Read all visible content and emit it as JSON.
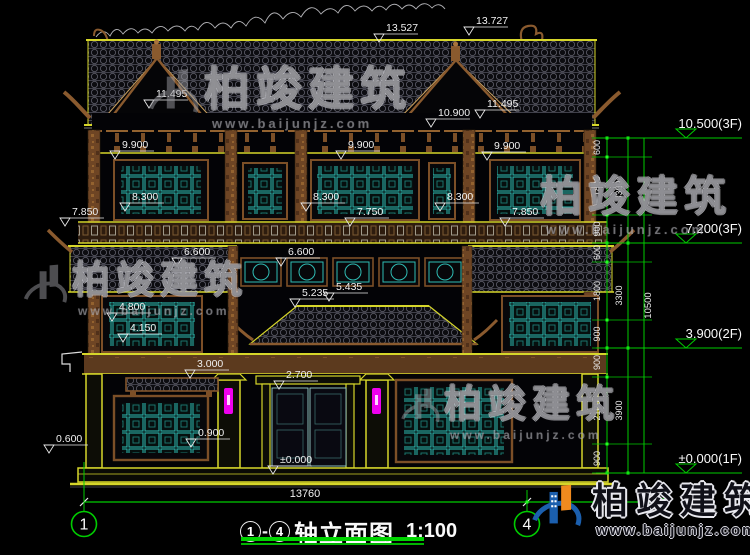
{
  "colors": {
    "background": "#000000",
    "dim_line_green": "#00cc00",
    "bright_green": "#22ff22",
    "outline_yellow": "#d6d62a",
    "wood_brown": "#8a5a2e",
    "window_teal": "#2fbcb4",
    "lamp_magenta": "#ee00ee",
    "text_white": "#f0f0f0",
    "logo_blue": "#1b5fae",
    "logo_orange": "#f08a1e"
  },
  "watermark": {
    "brand": "柏竣建筑",
    "url": "www.baijunjz.com"
  },
  "brand_logo": {
    "brand": "柏竣建筑",
    "url": "www.baijunjz.com"
  },
  "title_block": {
    "axis_start": "1",
    "axis_end": "4",
    "title": "轴立面图",
    "scale": "1:100"
  },
  "axes": [
    {
      "label": "1"
    },
    {
      "label": "4"
    }
  ],
  "bottom_dimension": "13760",
  "spot_elevations": [
    {
      "value": "13.527",
      "x": 386,
      "y": 31
    },
    {
      "value": "13.727",
      "x": 476,
      "y": 24
    },
    {
      "value": "11.495",
      "x": 156,
      "y": 97
    },
    {
      "value": "11.495",
      "x": 487,
      "y": 107
    },
    {
      "value": "10.900",
      "x": 438,
      "y": 116
    },
    {
      "value": "9.900",
      "x": 122,
      "y": 148
    },
    {
      "value": "9.900",
      "x": 348,
      "y": 148
    },
    {
      "value": "9.900",
      "x": 494,
      "y": 149
    },
    {
      "value": "8.300",
      "x": 132,
      "y": 200
    },
    {
      "value": "8.300",
      "x": 313,
      "y": 200
    },
    {
      "value": "8.300",
      "x": 447,
      "y": 200
    },
    {
      "value": "7.850",
      "x": 72,
      "y": 215
    },
    {
      "value": "7.750",
      "x": 357,
      "y": 215
    },
    {
      "value": "7.850",
      "x": 512,
      "y": 215
    },
    {
      "value": "6.600",
      "x": 184,
      "y": 255
    },
    {
      "value": "6.600",
      "x": 288,
      "y": 255
    },
    {
      "value": "5.435",
      "x": 336,
      "y": 290
    },
    {
      "value": "5.235",
      "x": 302,
      "y": 296
    },
    {
      "value": "4.800",
      "x": 119,
      "y": 310
    },
    {
      "value": "4.150",
      "x": 130,
      "y": 331
    },
    {
      "value": "3.000",
      "x": 197,
      "y": 367
    },
    {
      "value": "2.700",
      "x": 286,
      "y": 378
    },
    {
      "value": "0.900",
      "x": 198,
      "y": 436
    },
    {
      "value": "0.600",
      "x": 56,
      "y": 442
    },
    {
      "value": "±0.000",
      "x": 280,
      "y": 463
    }
  ],
  "right_chain": {
    "x_main": 607,
    "x_sub": 628,
    "x_total": 644,
    "top": 138,
    "bottom": 473,
    "ticks": [
      138,
      157,
      215,
      243,
      262,
      320,
      348,
      377,
      444,
      473
    ],
    "segments": [
      {
        "v": "600",
        "y1": 138,
        "y2": 157
      },
      {
        "v": "1800",
        "y1": 157,
        "y2": 215
      },
      {
        "v": "900",
        "y1": 215,
        "y2": 243
      },
      {
        "v": "600",
        "y1": 243,
        "y2": 262
      },
      {
        "v": "1800",
        "y1": 262,
        "y2": 320
      },
      {
        "v": "900",
        "y1": 320,
        "y2": 348
      },
      {
        "v": "900",
        "y1": 348,
        "y2": 377
      },
      {
        "v": "2100",
        "y1": 377,
        "y2": 444
      },
      {
        "v": "900",
        "y1": 444,
        "y2": 473
      }
    ],
    "subtotals": [
      {
        "v": "3300",
        "y1": 138,
        "y2": 243
      },
      {
        "v": "3300",
        "y1": 243,
        "y2": 348
      },
      {
        "v": "3900",
        "y1": 348,
        "y2": 473
      }
    ],
    "overall": {
      "v": "10500",
      "y1": 138,
      "y2": 473
    },
    "levels": [
      {
        "v": "10.500(3F)",
        "y": 138
      },
      {
        "v": "7.200(3F)",
        "y": 243
      },
      {
        "v": "3.900(2F)",
        "y": 348
      },
      {
        "v": "±0.000(1F)",
        "y": 473
      }
    ]
  }
}
